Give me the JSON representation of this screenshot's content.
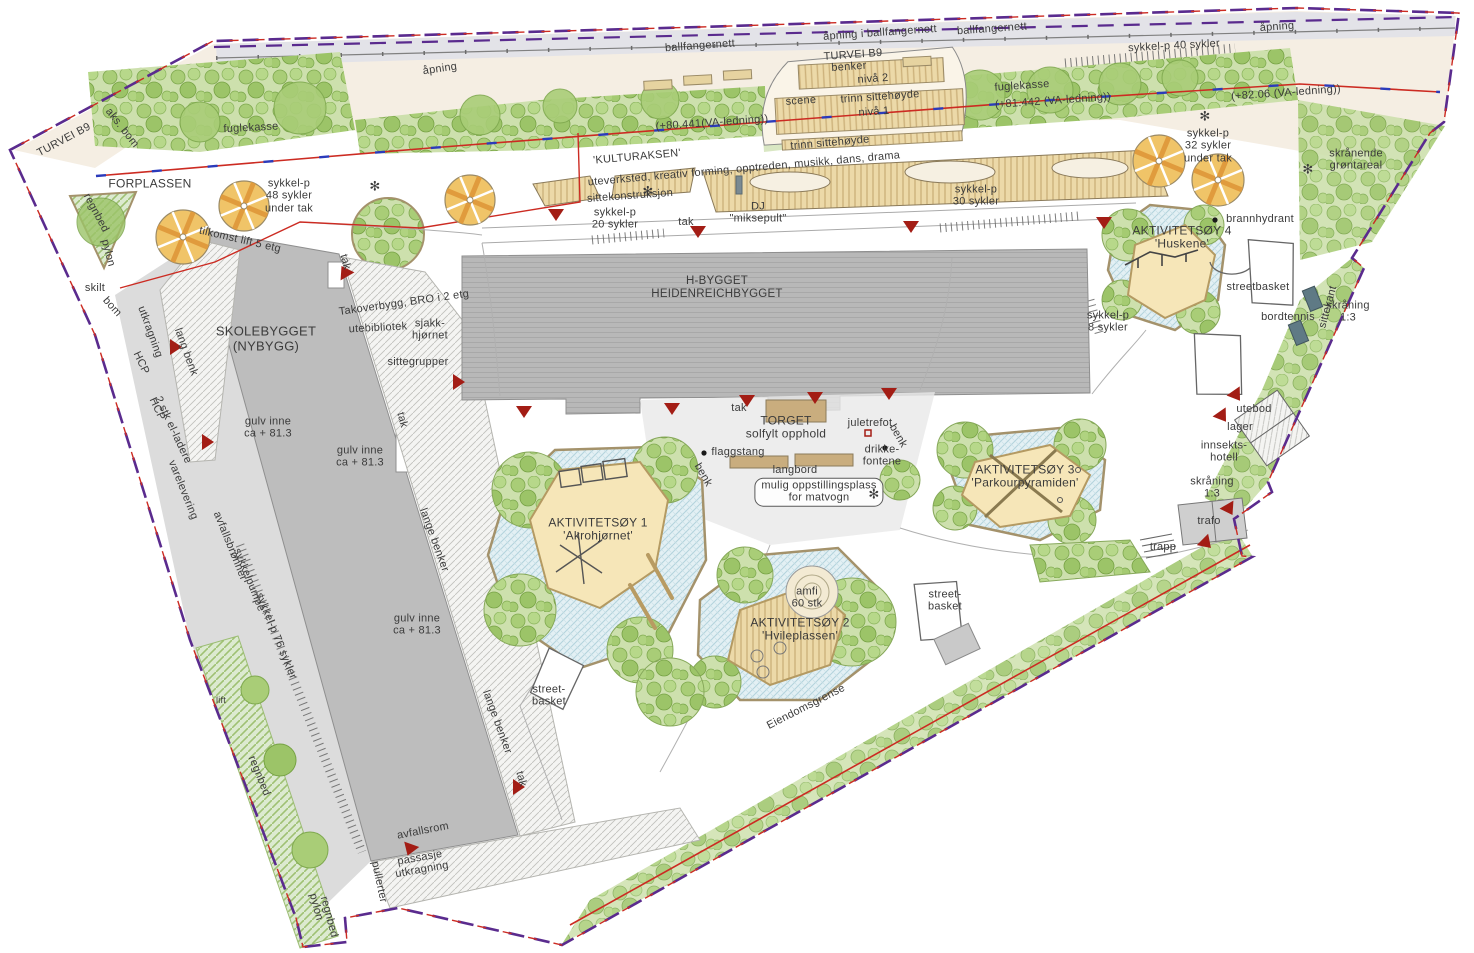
{
  "plan": {
    "language": "norwegian",
    "type": "landscape-site-plan"
  },
  "colors": {
    "boundary_purple": "#5a2b8e",
    "va_red": "#cc2b22",
    "va_blue": "#2b3bbb",
    "marker_red": "#a31d15",
    "canopy_yellow": "#f0c468",
    "canopy_orange": "#e09b3d",
    "green_light": "#cde0ad",
    "paving_blue": "#e3f0f4",
    "island_cream": "#f6e6b8",
    "building_gray": "#b9b9b9",
    "path_beige": "#f5eee3",
    "label_gray": "#3b3b3b"
  },
  "labels": [
    {
      "id": "ballfangernett-1",
      "t": "ballfangernett",
      "x": 700,
      "y": 46,
      "r": -4
    },
    {
      "id": "apning-i-ballfangernett",
      "t": "åpning i ballfangernett",
      "x": 880,
      "y": 33,
      "r": -4
    },
    {
      "id": "ballfangernett-2",
      "t": "ballfangernett",
      "x": 992,
      "y": 29,
      "r": -4
    },
    {
      "id": "apning-right",
      "t": "åpning",
      "x": 1277,
      "y": 27,
      "r": -4
    },
    {
      "id": "apning-left",
      "t": "åpning",
      "x": 440,
      "y": 69,
      "r": -8
    },
    {
      "id": "turvei-b9-top",
      "t": "TURVEI B9",
      "x": 853,
      "y": 55,
      "r": -4
    },
    {
      "id": "benker",
      "t": "benker",
      "x": 849,
      "y": 67,
      "r": -4
    },
    {
      "id": "niva-2",
      "t": "nivå 2",
      "x": 873,
      "y": 79,
      "r": -4
    },
    {
      "id": "scene",
      "t": "scene",
      "x": 801,
      "y": 101,
      "r": -4
    },
    {
      "id": "trinn-sittehoyde-1",
      "t": "trinn sittehøyde",
      "x": 880,
      "y": 97,
      "r": -4
    },
    {
      "id": "niva-1",
      "t": "nivå 1",
      "x": 874,
      "y": 112,
      "r": -4
    },
    {
      "id": "trinn-sittehoyde-2",
      "t": "trinn sittehøyde",
      "x": 830,
      "y": 143,
      "r": -5
    },
    {
      "id": "va-80441",
      "t": "(+80.441(VA-ledning))",
      "x": 712,
      "y": 123,
      "r": -4
    },
    {
      "id": "va-81442",
      "t": "(+81.442 (VA-ledning))",
      "x": 1053,
      "y": 101,
      "r": -4
    },
    {
      "id": "va-8206",
      "t": "(+82.06 (VA-ledning))",
      "x": 1286,
      "y": 93,
      "r": -4
    },
    {
      "id": "fuglekasse-right",
      "t": "fuglekasse",
      "x": 1022,
      "y": 86,
      "r": -4
    },
    {
      "id": "fuglekasse-left",
      "t": "fuglekasse",
      "x": 251,
      "y": 128,
      "r": -3
    },
    {
      "id": "turvei-b9-left",
      "t": "TURVEI B9",
      "x": 64,
      "y": 140,
      "r": -28
    },
    {
      "id": "aks-bom",
      "t": "aks. bom",
      "x": 122,
      "y": 128,
      "r": 52
    },
    {
      "id": "sykkel-40",
      "t": "sykkel-p 40 sykler",
      "x": 1174,
      "y": 46,
      "r": -3
    },
    {
      "id": "forplassen",
      "t": "FORPLASSEN",
      "x": 150,
      "y": 184,
      "fs": 12
    },
    {
      "id": "sykkel-48",
      "t": "sykkel-p\n48 sykler\nunder tak",
      "x": 289,
      "y": 196
    },
    {
      "id": "regnbed-forplass",
      "t": "regnbed",
      "x": 96,
      "y": 213,
      "r": 62
    },
    {
      "id": "pylon-forplass",
      "t": "pylon",
      "x": 108,
      "y": 253,
      "r": 75
    },
    {
      "id": "tilkomst-lift",
      "t": "tilkomst lift 5 etg",
      "x": 240,
      "y": 240,
      "r": 13
    },
    {
      "id": "skilt",
      "t": "skilt",
      "x": 95,
      "y": 288
    },
    {
      "id": "bom",
      "t": "bom",
      "x": 112,
      "y": 307,
      "r": 48
    },
    {
      "id": "kulturaksen",
      "t": "'KULTURAKSEN'",
      "x": 637,
      "y": 157,
      "r": -5
    },
    {
      "id": "kulturaksen-sub",
      "t": "uteverksted, kreativ forming, opptreden, musikk, dans, drama",
      "x": 744,
      "y": 169,
      "r": -5
    },
    {
      "id": "sittekonstruksjon",
      "t": "sittekonstruksjon",
      "x": 630,
      "y": 196,
      "r": -4
    },
    {
      "id": "sykkel-20",
      "t": "sykkel-p\n20 sykler",
      "x": 615,
      "y": 219
    },
    {
      "id": "tak-kulturaksen",
      "t": "tak",
      "x": 686,
      "y": 222
    },
    {
      "id": "dj-miksepult",
      "t": "DJ\n\"miksepult\"",
      "x": 758,
      "y": 213
    },
    {
      "id": "sykkel-30",
      "t": "sykkel-p\n30 sykler",
      "x": 976,
      "y": 196
    },
    {
      "id": "sykkel-32",
      "t": "sykkel-p\n32 sykler\nunder tak",
      "x": 1208,
      "y": 146
    },
    {
      "id": "skranende-grontareal",
      "t": "skrånende\ngrøntareal",
      "x": 1356,
      "y": 160
    },
    {
      "id": "aktivitetsoy-4",
      "t": "AKTIVITETSØY 4\n'Huskene'",
      "x": 1182,
      "y": 238,
      "fs": 12
    },
    {
      "id": "brannhydrant",
      "t": "brannhydrant",
      "x": 1260,
      "y": 219
    },
    {
      "id": "streetbasket-ne",
      "t": "streetbasket",
      "x": 1258,
      "y": 287
    },
    {
      "id": "bordtennis",
      "t": "bordtennis",
      "x": 1288,
      "y": 317
    },
    {
      "id": "sittekant",
      "t": "sittekant",
      "x": 1328,
      "y": 307,
      "r": -75
    },
    {
      "id": "skraning-ne",
      "t": "skråning\n1:3",
      "x": 1348,
      "y": 312
    },
    {
      "id": "sykkel-8",
      "t": "sykkel-p\n8 sykler",
      "x": 1108,
      "y": 322
    },
    {
      "id": "skolebygget",
      "t": "SKOLEBYGGET\n(NYBYGG)",
      "x": 266,
      "y": 339,
      "fs": 13
    },
    {
      "id": "takoverbygg-bro",
      "t": "Takoverbygg, BRO i 2 etg",
      "x": 404,
      "y": 303,
      "r": -8
    },
    {
      "id": "utebibliotek",
      "t": "utebibliotek",
      "x": 378,
      "y": 328,
      "r": -3
    },
    {
      "id": "sjakkhjornet",
      "t": "sjakk-\nhjørnet",
      "x": 430,
      "y": 330
    },
    {
      "id": "sittegrupper",
      "t": "sittegrupper",
      "x": 418,
      "y": 362
    },
    {
      "id": "utkragning-nw",
      "t": "utkragning",
      "x": 150,
      "y": 332,
      "r": 70
    },
    {
      "id": "hcp-1",
      "t": "HCP",
      "x": 141,
      "y": 363,
      "r": 65
    },
    {
      "id": "hcp-2",
      "t": "HCP",
      "x": 157,
      "y": 409,
      "r": 65
    },
    {
      "id": "el-ladere",
      "t": "2 stk el-ladere",
      "x": 173,
      "y": 430,
      "r": 65
    },
    {
      "id": "lang-benk",
      "t": "lang benk",
      "x": 186,
      "y": 352,
      "r": 70
    },
    {
      "id": "gulv-inne-1",
      "t": "gulv inne\nca + 81.3",
      "x": 268,
      "y": 428
    },
    {
      "id": "gulv-inne-2",
      "t": "gulv inne\nca + 81.3",
      "x": 360,
      "y": 457
    },
    {
      "id": "gulv-inne-3",
      "t": "gulv inne\nca + 81.3",
      "x": 417,
      "y": 625
    },
    {
      "id": "varelevering",
      "t": "varelevering",
      "x": 183,
      "y": 490,
      "r": 68
    },
    {
      "id": "avfallsbronner",
      "t": "avfallsbrønner",
      "x": 230,
      "y": 546,
      "r": 68
    },
    {
      "id": "sykkelpumpe",
      "t": "sykkelpumpe",
      "x": 249,
      "y": 580,
      "r": 68
    },
    {
      "id": "sykkel-76",
      "t": "sykkel-p 76 sykler",
      "x": 276,
      "y": 636,
      "r": 68
    },
    {
      "id": "lift",
      "t": "lift",
      "x": 221,
      "y": 700,
      "fs": 9
    },
    {
      "id": "regnbed-strip",
      "t": "regnbed",
      "x": 259,
      "y": 776,
      "r": 68
    },
    {
      "id": "avfallsrom",
      "t": "avfallsrom",
      "x": 423,
      "y": 831,
      "r": -11
    },
    {
      "id": "passasje-utkragning",
      "t": "passasje\nutkragning",
      "x": 421,
      "y": 864,
      "r": -10
    },
    {
      "id": "pullerter",
      "t": "pullerter",
      "x": 379,
      "y": 882,
      "r": 78
    },
    {
      "id": "pylon-sw",
      "t": "pylon",
      "x": 316,
      "y": 907,
      "r": 75
    },
    {
      "id": "regnbed-sw",
      "t": "regnbed",
      "x": 329,
      "y": 917,
      "r": 75
    },
    {
      "id": "h-bygget",
      "t": "H-BYGGET\nHEIDENREICHBYGGET",
      "x": 717,
      "y": 288,
      "fs": 11.5
    },
    {
      "id": "tak-skole-ne",
      "t": "tak",
      "x": 345,
      "y": 262,
      "r": 75
    },
    {
      "id": "tak-skole-e",
      "t": "tak",
      "x": 402,
      "y": 420,
      "r": 75
    },
    {
      "id": "tak-torget",
      "t": "tak",
      "x": 739,
      "y": 408
    },
    {
      "id": "torget",
      "t": "TORGET\nsolfylt opphold",
      "x": 786,
      "y": 428,
      "fs": 12
    },
    {
      "id": "juletrefot",
      "t": "juletrefot",
      "x": 870,
      "y": 423
    },
    {
      "id": "drikkefontene",
      "t": "drikke-\nfontene",
      "x": 882,
      "y": 456
    },
    {
      "id": "benk-e",
      "t": "benk",
      "x": 898,
      "y": 436,
      "r": 60
    },
    {
      "id": "flaggstang",
      "t": "flaggstang",
      "x": 738,
      "y": 452
    },
    {
      "id": "langbord",
      "t": "langbord",
      "x": 795,
      "y": 470
    },
    {
      "id": "benk-w",
      "t": "benk",
      "x": 703,
      "y": 475,
      "r": 60
    },
    {
      "id": "matvogn",
      "t": "mulig oppstillingsplass\nfor matvogn",
      "x": 819,
      "y": 492,
      "box": true
    },
    {
      "id": "aktivitetsoy-3",
      "t": "AKTIVITETSØY 3\n'Parkourpyramiden'",
      "x": 1025,
      "y": 477,
      "fs": 12
    },
    {
      "id": "aktivitetsoy-1",
      "t": "AKTIVITETSØY 1\n'Akrohjørnet'",
      "x": 598,
      "y": 530,
      "fs": 12
    },
    {
      "id": "lange-benker-1",
      "t": "lange benker",
      "x": 434,
      "y": 540,
      "r": 70
    },
    {
      "id": "lange-benker-2",
      "t": "lange benker",
      "x": 497,
      "y": 722,
      "r": 70
    },
    {
      "id": "amfi",
      "t": "amfi\n60 stk",
      "x": 807,
      "y": 598
    },
    {
      "id": "aktivitetsoy-2",
      "t": "AKTIVITETSØY 2\n'Hvileplassen'",
      "x": 800,
      "y": 630,
      "fs": 12
    },
    {
      "id": "streetbasket-se",
      "t": "street-\nbasket",
      "x": 945,
      "y": 601
    },
    {
      "id": "streetbasket-s",
      "t": "street-\nbasket",
      "x": 549,
      "y": 696
    },
    {
      "id": "tak-s",
      "t": "tak",
      "x": 521,
      "y": 779,
      "r": 75
    },
    {
      "id": "eiendomsgrense",
      "t": "Eiendomsgrense",
      "x": 806,
      "y": 707,
      "r": -27
    },
    {
      "id": "trapp",
      "t": "trapp",
      "x": 1163,
      "y": 547
    },
    {
      "id": "trafo",
      "t": "trafo",
      "x": 1209,
      "y": 521
    },
    {
      "id": "skraning-se",
      "t": "skråning\n1:3",
      "x": 1212,
      "y": 488
    },
    {
      "id": "innsektshotell",
      "t": "innsekts-\nhotell",
      "x": 1224,
      "y": 452
    },
    {
      "id": "lager",
      "t": "lager",
      "x": 1240,
      "y": 427
    },
    {
      "id": "utebod",
      "t": "utebod",
      "x": 1254,
      "y": 409
    },
    {
      "id": "tree-marker-1",
      "t": "✻",
      "x": 375,
      "y": 187,
      "fs": 13
    },
    {
      "id": "tree-marker-2",
      "t": "✻",
      "x": 648,
      "y": 192,
      "fs": 13
    },
    {
      "id": "tree-marker-3",
      "t": "✻",
      "x": 1205,
      "y": 117,
      "fs": 13
    },
    {
      "id": "tree-marker-4",
      "t": "✻",
      "x": 1308,
      "y": 170,
      "fs": 13
    },
    {
      "id": "tree-marker-5",
      "t": "✻",
      "x": 874,
      "y": 495,
      "fs": 13
    }
  ],
  "icons": {
    "entrance_arrows": [
      [
        556,
        214,
        0
      ],
      [
        698,
        231,
        0
      ],
      [
        911,
        226,
        0
      ],
      [
        1104,
        222,
        0
      ],
      [
        458,
        382,
        -90
      ],
      [
        524,
        411,
        0
      ],
      [
        672,
        408,
        0
      ],
      [
        747,
        400,
        0
      ],
      [
        815,
        397,
        0
      ],
      [
        889,
        393,
        0
      ],
      [
        1236,
        395,
        -35
      ],
      [
        1222,
        416,
        -35
      ],
      [
        1229,
        509,
        -30
      ],
      [
        1206,
        543,
        -45
      ],
      [
        410,
        849,
        20
      ],
      [
        518,
        787,
        -90
      ],
      [
        175,
        347,
        -90
      ],
      [
        207,
        442,
        -90
      ],
      [
        345,
        272,
        150
      ]
    ],
    "bike_canopies": [
      [
        183,
        237,
        27
      ],
      [
        244,
        206,
        25
      ],
      [
        470,
        200,
        25
      ],
      [
        1159,
        161,
        26
      ],
      [
        1218,
        180,
        26
      ]
    ],
    "point_markers": [
      [
        704,
        453
      ],
      [
        885,
        448
      ],
      [
        1215,
        220
      ]
    ],
    "tree_foot_marker": [
      [
        868,
        433
      ]
    ]
  }
}
